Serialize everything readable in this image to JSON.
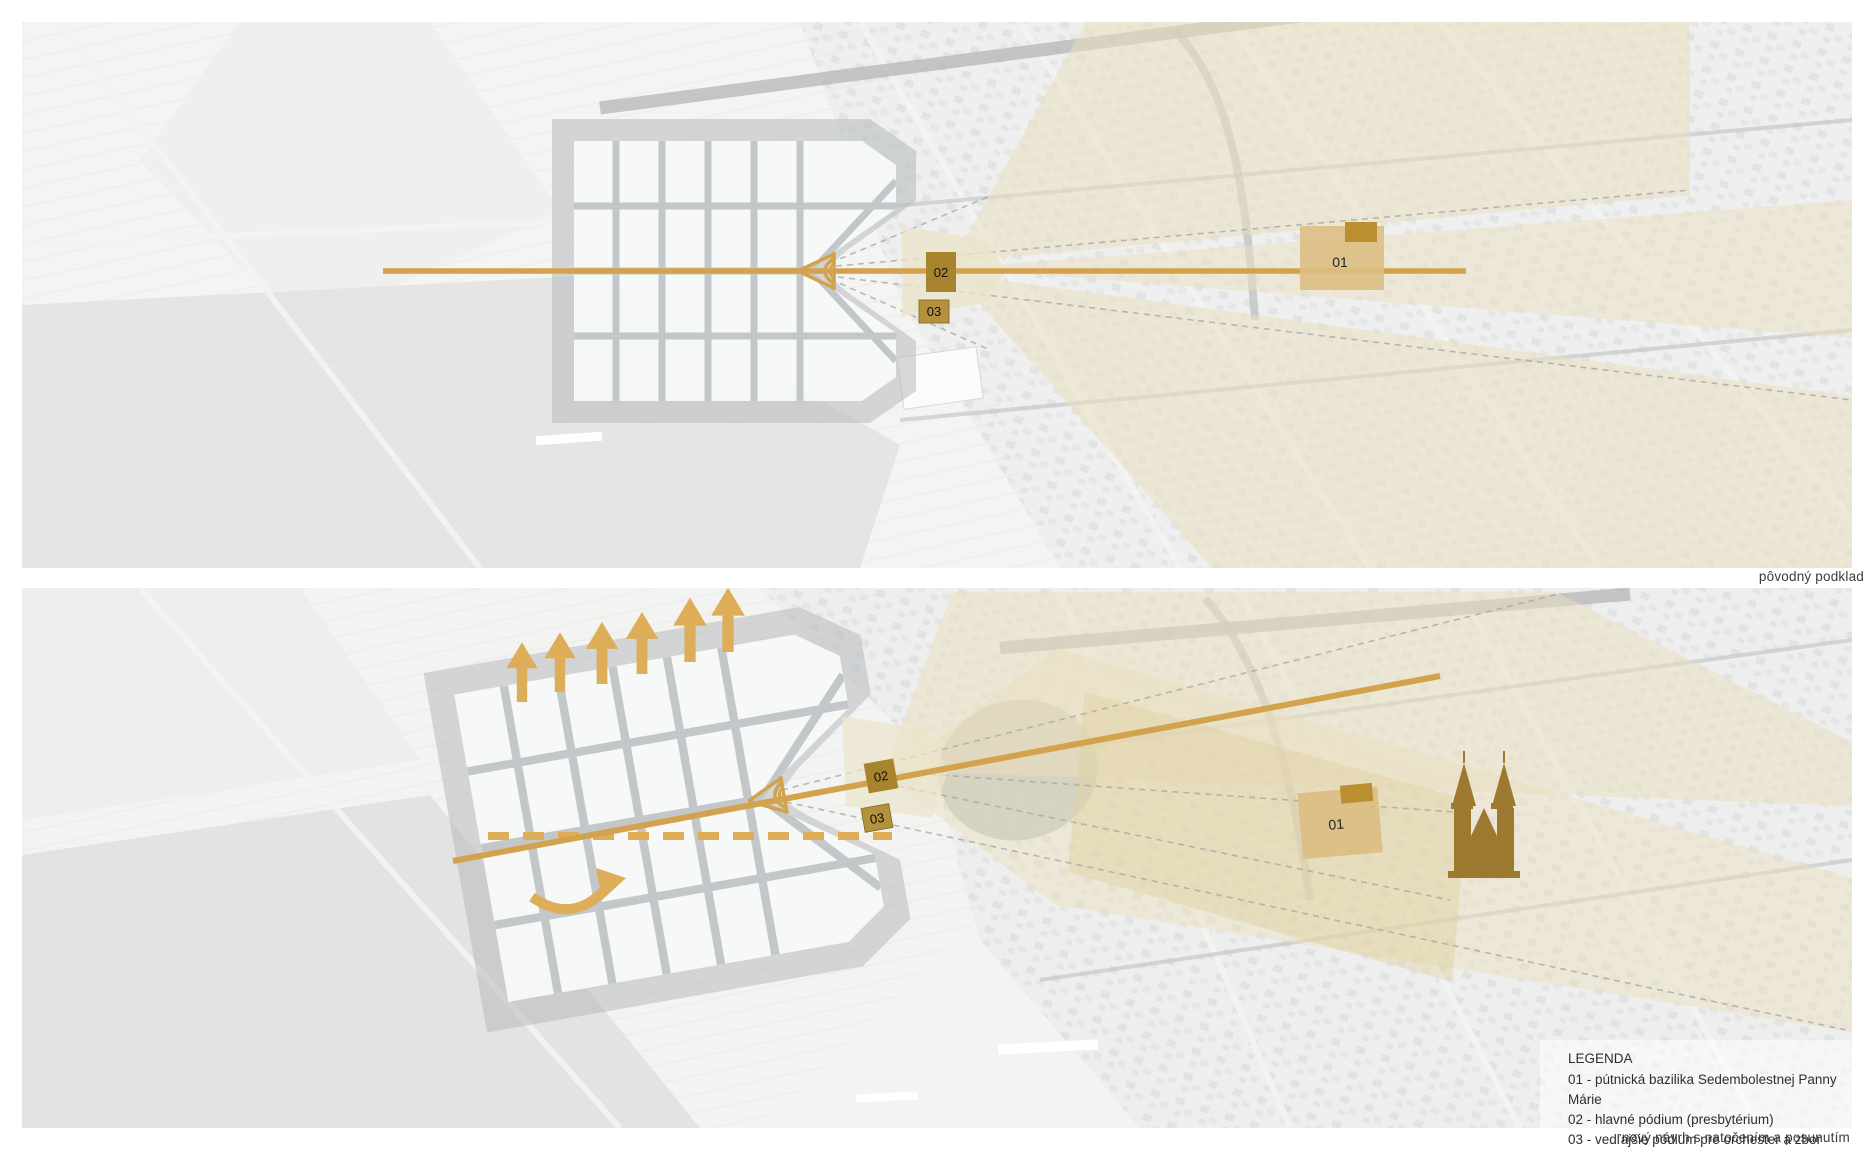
{
  "colors": {
    "gold": "#d2a24c",
    "gold_light": "#ddad57",
    "cone": "#eadfbe",
    "cone_dark": "#e0d0a0",
    "stage_zone": "#ece4cb",
    "marker_dark": "#a8842f",
    "marker_mid": "#b4923d",
    "block_light": "#dcbd82",
    "block_dark": "#b98f2f",
    "church": "#9d7930"
  },
  "panels": [
    {
      "caption": "pôvodný podklad",
      "markers": {
        "m01": "01",
        "m02": "02",
        "m03": "03"
      }
    },
    {
      "caption": "nový návrh s natočením a posunutím",
      "markers": {
        "m01": "01",
        "m02": "02",
        "m03": "03"
      }
    }
  ],
  "legend": {
    "title": "LEGENDA",
    "items": [
      "01 - pútnická bazilika Sedembolestnej Panny Márie",
      "02 - hlavné pódium (presbytérium)",
      "03 - vedľajšie pódium pre orchester a zbor"
    ]
  }
}
